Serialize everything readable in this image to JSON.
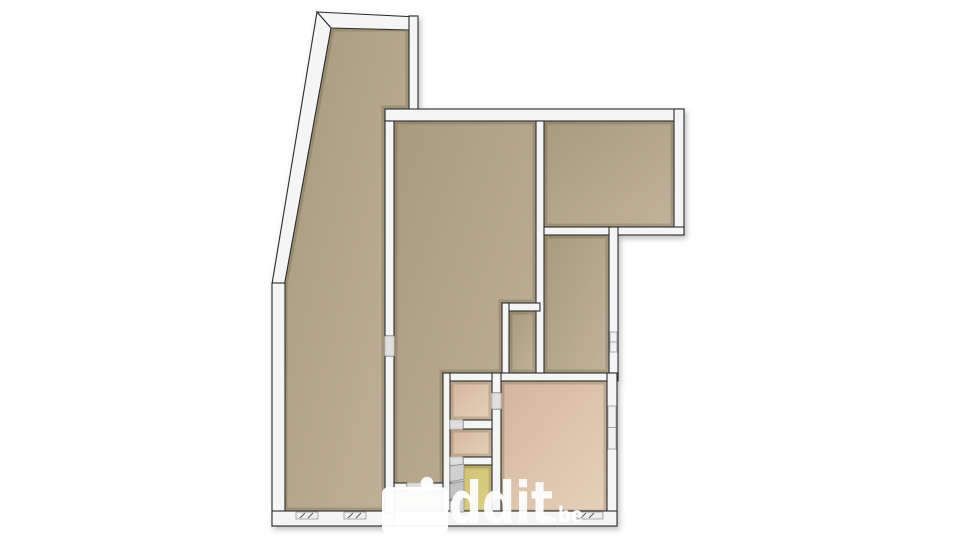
{
  "watermark": {
    "text": "ddit",
    "tld": ".be",
    "blob": [
      382,
      487,
      66,
      47
    ],
    "dot": [
      427,
      483,
      6.3
    ],
    "color": "#ffffff",
    "opacity": 0.93
  },
  "palette": {
    "background": "#ffffff",
    "outline": "#2c2c2c",
    "wall": "#f5f5f5",
    "wall_recess": "#ededed",
    "floor_dark_1": "#a89a7d",
    "floor_dark_2": "#c1b29a",
    "floor_pink_1": "#d3b79c",
    "floor_pink_2": "#e6d0ba",
    "floor_yellow_1": "#cdbf6e",
    "floor_yellow_2": "#ddd08a",
    "stair_gray": "#c9c9c9",
    "window_frame": "#9a9a9a",
    "window_tick": "#5a5a5a"
  },
  "floorplan": {
    "rooms": [
      {
        "id": "left-room",
        "fill": "dark",
        "pts": [
          [
            331,
            28
          ],
          [
            409,
            28
          ],
          [
            409,
            109
          ],
          [
            385,
            109
          ],
          [
            385,
            511
          ],
          [
            284,
            511
          ],
          [
            284,
            286
          ]
        ]
      },
      {
        "id": "middle-room",
        "fill": "dark",
        "pts": [
          [
            394,
            121
          ],
          [
            536,
            121
          ],
          [
            536,
            303
          ],
          [
            502,
            303
          ],
          [
            502,
            373
          ],
          [
            443,
            373
          ],
          [
            443,
            513
          ],
          [
            394,
            513
          ]
        ]
      },
      {
        "id": "closet-nook",
        "fill": "dark",
        "pts": [
          [
            509,
            311
          ],
          [
            536,
            311
          ],
          [
            536,
            373
          ],
          [
            509,
            373
          ]
        ]
      },
      {
        "id": "top-right-room",
        "fill": "dark",
        "pts": [
          [
            544,
            121
          ],
          [
            674,
            121
          ],
          [
            674,
            227
          ],
          [
            544,
            227
          ]
        ]
      },
      {
        "id": "mid-right-room",
        "fill": "dark",
        "pts": [
          [
            544,
            235
          ],
          [
            609,
            235
          ],
          [
            609,
            373
          ],
          [
            544,
            373
          ]
        ]
      },
      {
        "id": "bottom-right-room",
        "fill": "pink",
        "pts": [
          [
            501,
            381
          ],
          [
            607,
            381
          ],
          [
            607,
            513
          ],
          [
            501,
            513
          ]
        ]
      },
      {
        "id": "small-room-a",
        "fill": "pink",
        "pts": [
          [
            450,
            381
          ],
          [
            492,
            381
          ],
          [
            492,
            420
          ],
          [
            450,
            420
          ]
        ]
      },
      {
        "id": "small-room-b",
        "fill": "pink",
        "pts": [
          [
            450,
            429
          ],
          [
            492,
            429
          ],
          [
            492,
            457
          ],
          [
            450,
            457
          ]
        ]
      },
      {
        "id": "stair-room",
        "fill": "yellow",
        "pts": [
          [
            450,
            465
          ],
          [
            492,
            465
          ],
          [
            492,
            513
          ],
          [
            450,
            513
          ]
        ]
      }
    ],
    "walls": [
      {
        "id": "top-left-top-wall",
        "pts": [
          [
            317,
            12
          ],
          [
            417,
            17
          ],
          [
            409,
            30
          ],
          [
            331,
            28
          ]
        ]
      },
      {
        "id": "slanted-left-wall",
        "pts": [
          [
            317,
            12
          ],
          [
            331,
            28
          ],
          [
            284,
            287
          ],
          [
            272,
            284
          ]
        ]
      },
      {
        "id": "left-wall",
        "r": [
          272,
          283,
          13,
          243
        ]
      },
      {
        "id": "bottom-wall-left",
        "r": [
          272,
          511,
          122,
          15
        ]
      },
      {
        "id": "left-room-right-upper",
        "r": [
          409,
          16,
          9,
          105
        ]
      },
      {
        "id": "top-wall-main",
        "r": [
          385,
          109,
          299,
          12
        ]
      },
      {
        "id": "left-divider-upper",
        "r": [
          385,
          121,
          9,
          215
        ]
      },
      {
        "id": "left-divider-lower",
        "r": [
          385,
          356,
          9,
          157
        ]
      },
      {
        "id": "mid-divider",
        "r": [
          536,
          121,
          8,
          260
        ]
      },
      {
        "id": "top-right-right-wall",
        "r": [
          674,
          109,
          10,
          126
        ]
      },
      {
        "id": "top-right-bottom-wall",
        "r": [
          544,
          227,
          140,
          8
        ]
      },
      {
        "id": "mid-right-right-wall",
        "r": [
          609,
          227,
          9,
          154
        ]
      },
      {
        "id": "closet-top-wall",
        "r": [
          502,
          303,
          38,
          8
        ]
      },
      {
        "id": "closet-left-wall",
        "r": [
          502,
          303,
          7,
          78
        ]
      },
      {
        "id": "south-divider-wall",
        "r": [
          443,
          373,
          175,
          8
        ]
      },
      {
        "id": "cluster-left-wall",
        "r": [
          443,
          373,
          7,
          148
        ]
      },
      {
        "id": "cluster-right-wall-a",
        "r": [
          492,
          373,
          9,
          20
        ]
      },
      {
        "id": "cluster-right-wall-b",
        "r": [
          492,
          409,
          9,
          112
        ]
      },
      {
        "id": "ab-divider-wall",
        "r": [
          463,
          420,
          29,
          9
        ]
      },
      {
        "id": "bc-divider-wall",
        "r": [
          463,
          457,
          29,
          8
        ]
      },
      {
        "id": "pink-right-wall",
        "r": [
          607,
          373,
          10,
          153
        ]
      },
      {
        "id": "bottom-wall-right",
        "r": [
          394,
          511,
          223,
          15
        ]
      },
      {
        "id": "corridor-door-wall-a",
        "r": [
          394,
          483,
          13,
          8
        ]
      },
      {
        "id": "corridor-door-wall-b",
        "r": [
          428,
          483,
          15,
          8
        ]
      }
    ],
    "door_thresholds": [
      [
        385,
        336,
        9,
        20
      ],
      [
        407,
        483,
        21,
        8
      ],
      [
        492,
        393,
        9,
        16
      ],
      [
        450,
        420,
        13,
        9
      ],
      [
        450,
        457,
        13,
        8
      ]
    ],
    "windows_h": [
      [
        296,
        512,
        22,
        7
      ],
      [
        344,
        512,
        22,
        7
      ],
      [
        577,
        512,
        26,
        7
      ]
    ],
    "windows_v": [
      [
        608,
        406,
        8,
        43
      ],
      [
        610,
        332,
        7,
        20
      ]
    ],
    "stairs": [
      [
        [
          450,
          466
        ],
        [
          464,
          464
        ],
        [
          464,
          479
        ],
        [
          450,
          482
        ]
      ],
      [
        [
          450,
          484
        ],
        [
          464,
          481
        ],
        [
          464,
          496
        ],
        [
          450,
          499
        ]
      ],
      [
        [
          450,
          501
        ],
        [
          464,
          498
        ],
        [
          464,
          512
        ],
        [
          450,
          512
        ]
      ]
    ]
  }
}
